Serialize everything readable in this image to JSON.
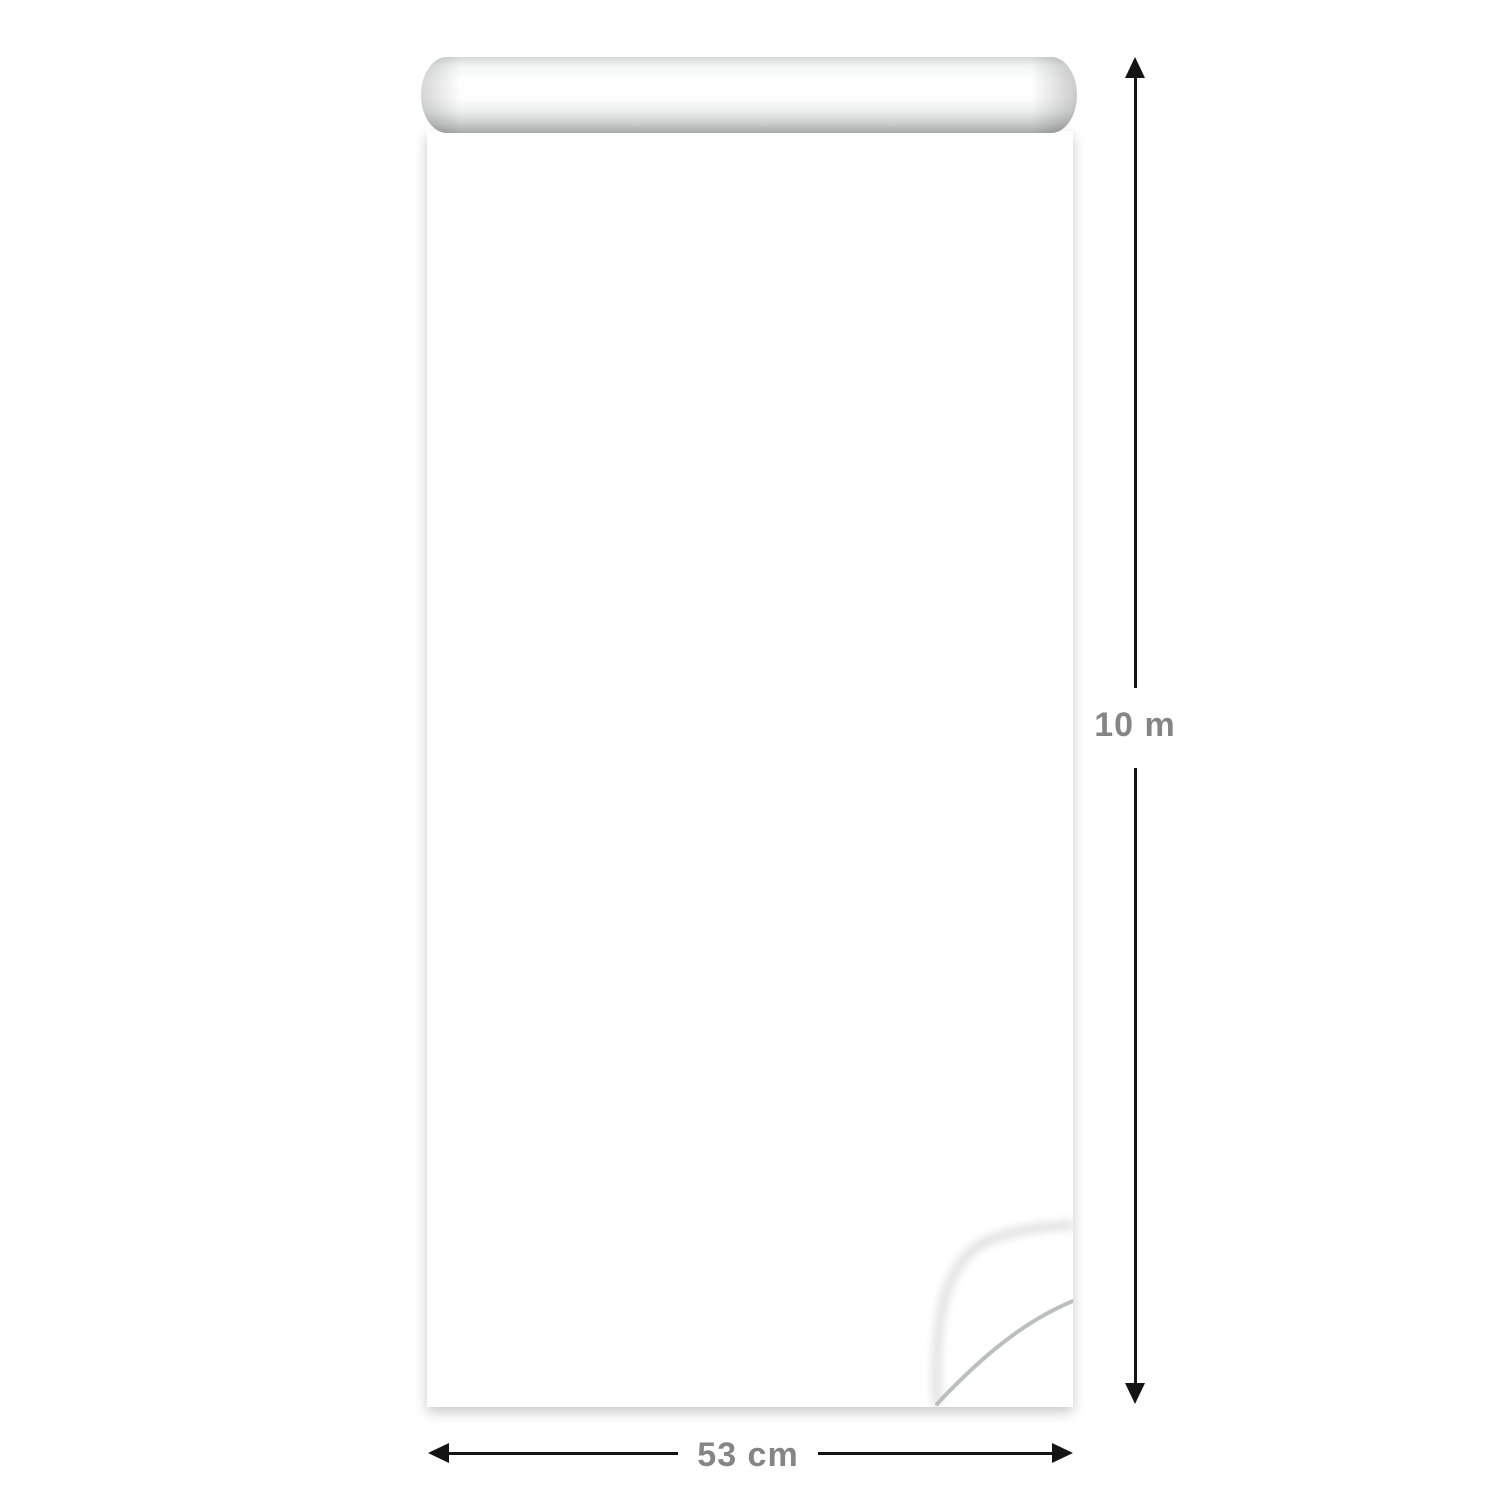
{
  "image_type": "wallpaper roll product visualization",
  "product": {
    "name": "Patterned wallpaper roll",
    "pattern_description": "Hand-drawn Polynesian tribal motifs in teal and white on a black background"
  },
  "dimensions": {
    "height_label": "10 m",
    "width_label": "53 cm"
  },
  "palette": {
    "page_background": "#ffffff",
    "pattern_background": "#05090c",
    "teal": "#3aa4ba",
    "teal_dark": "#1e7389",
    "teal_light": "#86d3dc",
    "ink_white": "#e7efec",
    "arrow_black": "#141414",
    "label_gray": "#858585",
    "roll_gray": "#a6aaaa"
  },
  "motifs": [
    "sun-tiki-face",
    "turtle",
    "manta-ray",
    "scarab-beetle",
    "octopus",
    "fish",
    "fish-hook",
    "waves",
    "spiral-shield",
    "totem-ladder",
    "aztec-banner",
    "zigzag-arrows",
    "paisley-eye",
    "square-spiral",
    "tiki-dancer",
    "diamonds",
    "spirals",
    "triangles"
  ]
}
